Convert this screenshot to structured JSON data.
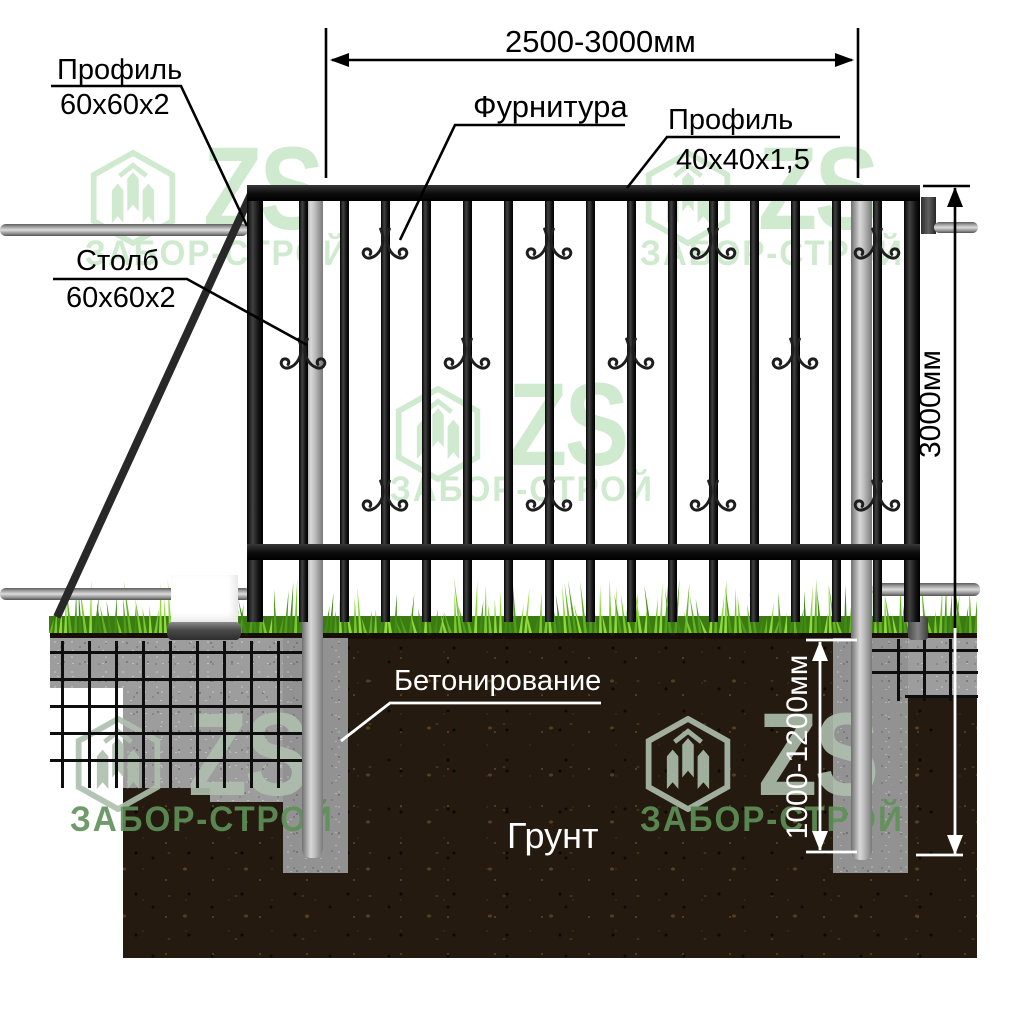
{
  "labels": {
    "profile_frame": {
      "title": "Профиль",
      "size": "60х60х2"
    },
    "post": {
      "title": "Столб",
      "size": "60х60х2"
    },
    "fittings": {
      "title": "Фурнитура"
    },
    "profile_picket": {
      "title": "Профиль",
      "size": "40х40х1,5"
    },
    "concreting": {
      "title": "Бетонирование"
    },
    "ground": {
      "title": "Грунт"
    }
  },
  "dimensions": {
    "section_width": "2500-3000мм",
    "post_height": "3000мм",
    "embed_depth": "1000-1200мм"
  },
  "watermark": {
    "brand_short": "ZS",
    "brand_full": "ЗАБОР-СТРОЙ"
  },
  "colors": {
    "watermark_green": "#cde9cd",
    "watermark_green_dark": "#5f9159",
    "metal_black": "#1a1a1a",
    "galvanized_gray": "#c4c4c4",
    "concrete_gray": "#9d9d9d",
    "soil_brown": "#241a10",
    "grass_green": "#6cbf27"
  }
}
